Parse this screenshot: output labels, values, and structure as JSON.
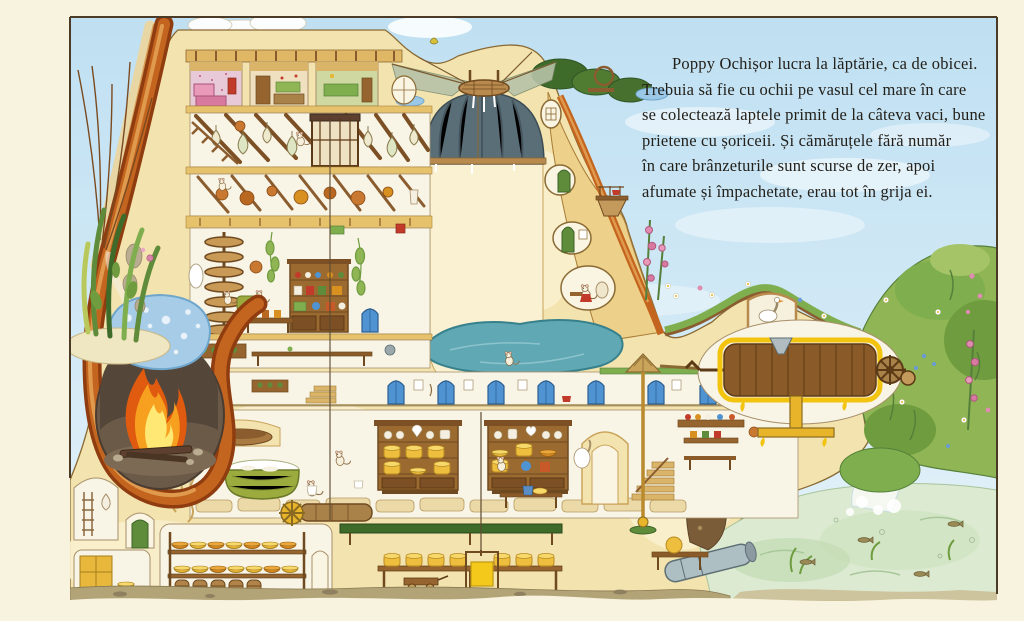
{
  "page": {
    "kind": "storybook-spread",
    "margin_color": "#f8f3de",
    "frame_color": "#4a3a26"
  },
  "story": {
    "language": "ro",
    "text": "Poppy Ochișor lucra la lăptărie, ca de obicei.\nTrebuia să fie cu ochii pe vasul cel mare în care\nse colectează laptele primit de la câteva vaci, bune\nprietene cu șoriceii. Și cămăruțele fără număr\nîn care brânzeturile sunt scurse de zer, apoi\nafumate și împachetate, erau tot în grija ei.",
    "text_color": "#23201a"
  },
  "palette": {
    "sky_top": "#bfe0f2",
    "sky_low": "#e8f4fa",
    "hill_cream": "#f3e3ae",
    "hill_light": "#f9efcd",
    "root_orange": "#c4651f",
    "root_dark": "#8f3d10",
    "fire_orange": "#f7a01f",
    "spring_pool_blue": "#a6cce8",
    "vat_slate": "#5a6e78",
    "pond_teal": "#5fa8b4",
    "door_blue": "#4f93d2",
    "cheese_yellow": "#eebf3f",
    "butter_gold": "#f5c91c",
    "grass_green": "#7fae4e",
    "stream_green": "#dcead2",
    "wood_brown": "#8a5a28",
    "soil_olive": "#b3a478"
  },
  "scene": {
    "elements": [
      "attic-bedrooms",
      "cheese-drying-room",
      "hanging-cheese-bags",
      "dumbwaiter-hoist",
      "copper-pots-room",
      "kitchen",
      "spiral-staircase",
      "great-milk-vat",
      "vat-canopy-net",
      "surface-pond",
      "spring-pool",
      "hearth-fire",
      "root-arch",
      "corridor-blue-doors",
      "cheese-dressers",
      "curd-tub",
      "cheese-cellar",
      "barrel-store",
      "butter-churn",
      "drive-gears",
      "waterwheel",
      "waterfall",
      "stream-with-fish",
      "whey-outflow-pipe",
      "butter-hoist-cage",
      "cliff-windows",
      "balcony-mice",
      "goose",
      "flower-bank",
      "left-plants"
    ]
  }
}
